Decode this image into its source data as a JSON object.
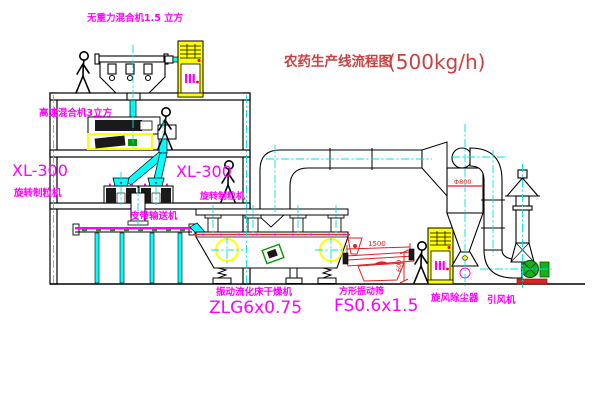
{
  "title": {
    "name": "农药生产线流程图",
    "capacity": "(500kg/h)"
  },
  "labels": {
    "gravity_mixer": "无重力混合机1.5 立方",
    "high_speed_mixer": "高速混合机3立方",
    "granulator_left_model": "XL-300",
    "granulator_left_name": "旋转制粒机",
    "granulator_right_model": "XL-300",
    "granulator_right_name": "旋转制粒机",
    "belt_conveyor": "皮带输送机",
    "dryer_name": "振动流化床干燥机",
    "dryer_model": "ZLG6x0.75",
    "screen_name": "方形振动筛",
    "screen_model": "FS0.6x1.5",
    "cyclone_name": "旋风除尘器",
    "fan_name": "引风机"
  },
  "dimensions": {
    "screen_length": "1500",
    "screen_height": "600",
    "cyclone_diameter": "Φ800"
  },
  "colors": {
    "label_magenta": "#ff00ff",
    "title_red": "#cb4040",
    "drawing_black": "#000000",
    "centerline_cyan": "#00e0e0",
    "cabinet_yellow": "#ffff00",
    "screen_red": "#dd2222",
    "machine_green": "#009900"
  }
}
